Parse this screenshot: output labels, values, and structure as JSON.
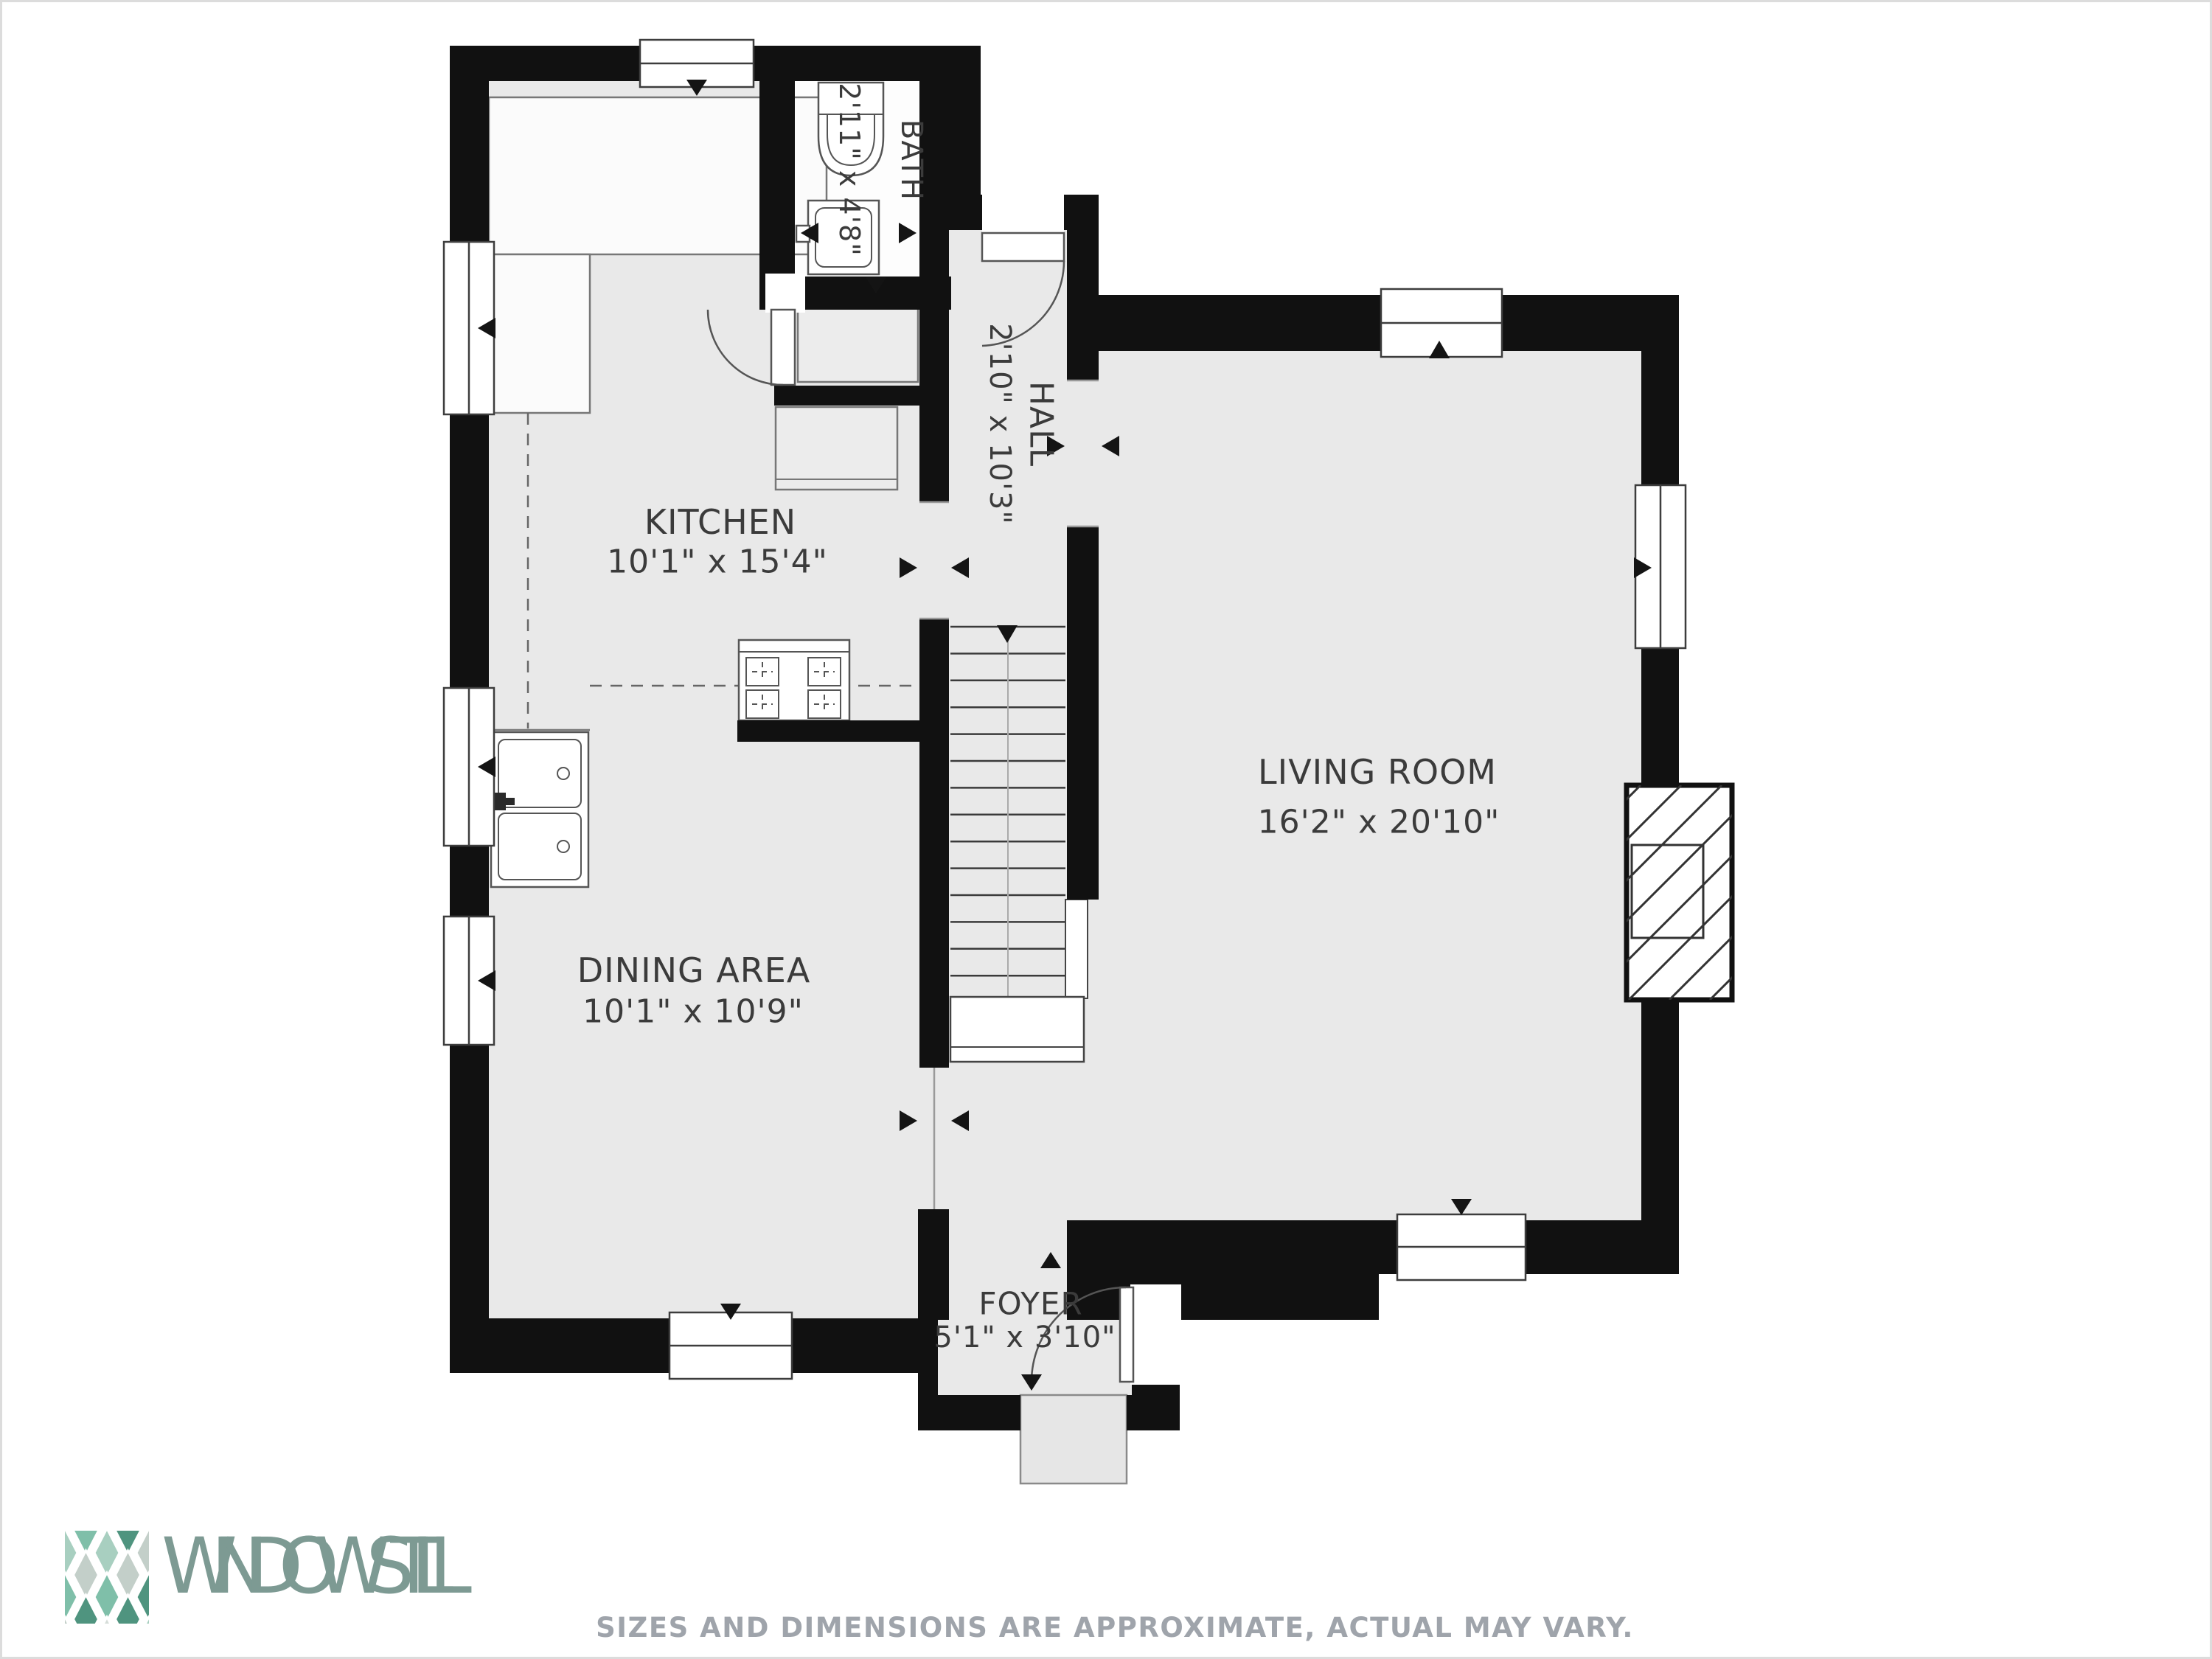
{
  "plan": {
    "rooms": [
      {
        "id": "kitchen",
        "name": "KITCHEN",
        "dims": "10'1\" x 15'4\""
      },
      {
        "id": "bath",
        "name": "BATH",
        "dims": "2'11\" x 4'8\""
      },
      {
        "id": "hall",
        "name": "HALL",
        "dims": "2'10\" x 10'3\""
      },
      {
        "id": "living-room",
        "name": "LIVING ROOM",
        "dims": "16'2\" x 20'10\""
      },
      {
        "id": "dining-area",
        "name": "DINING AREA",
        "dims": "10'1\" x 10'9\""
      },
      {
        "id": "foyer",
        "name": "FOYER",
        "dims": "5'1\" x 3'10\""
      }
    ],
    "colors": {
      "wall": "#111111",
      "floor": "#e9e9e9",
      "bath_floor": "#fdfdfd",
      "label": "#3b3b3b"
    }
  },
  "footer": {
    "brand": "WINDOWSTILL",
    "brand_color": "#7d9a93",
    "disclaimer": "SIZES AND DIMENSIONS ARE APPROXIMATE, ACTUAL MAY VARY.",
    "disclaimer_color": "#9fa4ab",
    "logo_palette": [
      "#4f947f",
      "#7fbfa9",
      "#a8cfc0",
      "#c3cfc9",
      "#d6ddd9"
    ],
    "logo_pattern": [
      0,
      2,
      1,
      3,
      1,
      3,
      0,
      4,
      1,
      2,
      1,
      4,
      0,
      3,
      0,
      2,
      1,
      3,
      0,
      2
    ]
  }
}
